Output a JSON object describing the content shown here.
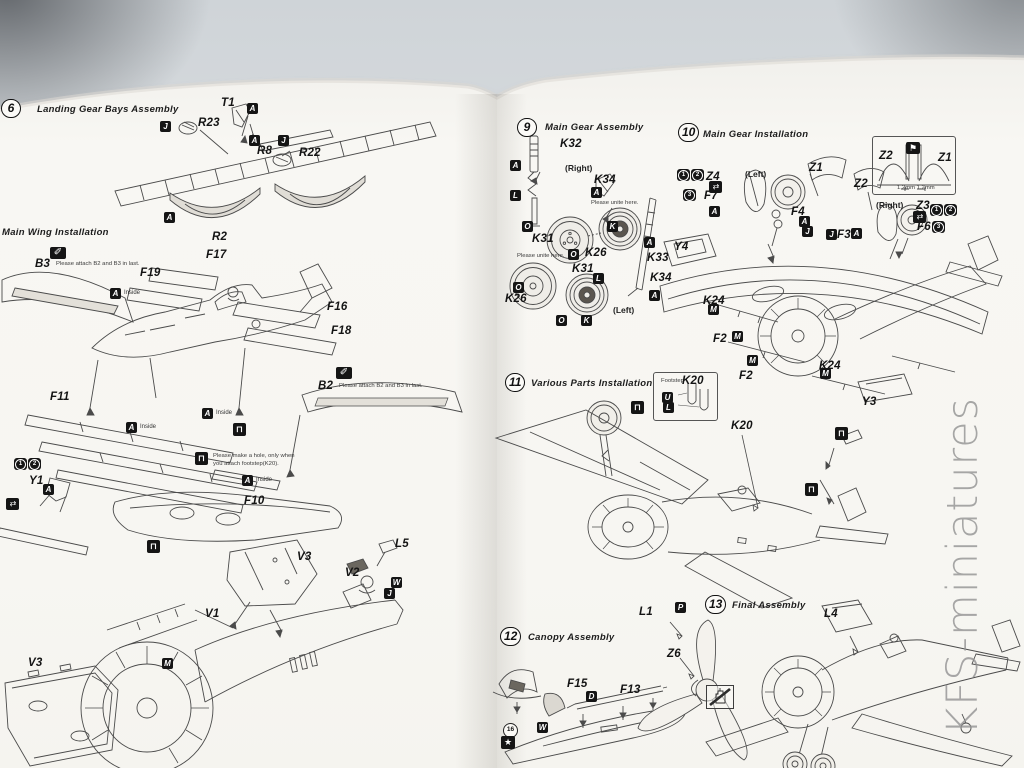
{
  "watermark": "KFS-miniatures",
  "colors": {
    "page": "#f8f7f3",
    "line": "#4b4b4b",
    "label": "#141414",
    "marker_bg": "#151515",
    "backdrop": "#d8dcdf"
  },
  "steps": [
    {
      "num": "6",
      "title": "Landing Gear Bays Assembly",
      "nx": 1,
      "ny": 99,
      "tx": 37,
      "ty": 104
    },
    {
      "num": null,
      "title": "Main Wing Installation",
      "nx": null,
      "ny": null,
      "tx": 2,
      "ty": 227
    },
    {
      "num": "9",
      "title": "Main Gear Assembly",
      "nx": 517,
      "ny": 118,
      "tx": 545,
      "ty": 122
    },
    {
      "num": "10",
      "title": "Main Gear Installation",
      "nx": 678,
      "ny": 123,
      "tx": 703,
      "ty": 129
    },
    {
      "num": "11",
      "title": "Various Parts Installation",
      "nx": 505,
      "ny": 373,
      "tx": 531,
      "ty": 378
    },
    {
      "num": "12",
      "title": "Canopy Assembly",
      "nx": 500,
      "ny": 627,
      "tx": 528,
      "ty": 632
    },
    {
      "num": "13",
      "title": "Final Assembly",
      "nx": 705,
      "ny": 595,
      "tx": 732,
      "ty": 600
    }
  ],
  "labels": [
    {
      "k": "part",
      "t": "T1",
      "x": 221,
      "y": 97
    },
    {
      "k": "paint",
      "t": "A",
      "x": 247,
      "y": 103
    },
    {
      "k": "paint",
      "t": "J",
      "x": 160,
      "y": 121
    },
    {
      "k": "part",
      "t": "R23",
      "x": 198,
      "y": 117
    },
    {
      "k": "paint",
      "t": "A",
      "x": 249,
      "y": 135
    },
    {
      "k": "paint",
      "t": "J",
      "x": 278,
      "y": 135
    },
    {
      "k": "part",
      "t": "R8",
      "x": 257,
      "y": 145
    },
    {
      "k": "part",
      "t": "R22",
      "x": 299,
      "y": 147
    },
    {
      "k": "paint",
      "t": "A",
      "x": 164,
      "y": 212
    },
    {
      "k": "part",
      "t": "R2",
      "x": 212,
      "y": 231
    },
    {
      "k": "glue",
      "x": 50,
      "y": 247
    },
    {
      "k": "part",
      "t": "B3",
      "x": 35,
      "y": 258
    },
    {
      "k": "note",
      "t": "Please attach B2 and B3 in last.",
      "x": 56,
      "y": 261,
      "nw": 1
    },
    {
      "k": "part",
      "t": "F17",
      "x": 206,
      "y": 249
    },
    {
      "k": "part",
      "t": "F19",
      "x": 140,
      "y": 267
    },
    {
      "k": "paint",
      "t": "A",
      "x": 110,
      "y": 288
    },
    {
      "k": "small",
      "t": "Inside",
      "x": 124,
      "y": 290
    },
    {
      "k": "part",
      "t": "F16",
      "x": 327,
      "y": 301
    },
    {
      "k": "part",
      "t": "F18",
      "x": 331,
      "y": 325
    },
    {
      "k": "glue",
      "x": 336,
      "y": 367
    },
    {
      "k": "part",
      "t": "B2",
      "x": 318,
      "y": 380
    },
    {
      "k": "note",
      "t": "Please attach B2 and B3 in last.",
      "x": 339,
      "y": 383,
      "nw": 1
    },
    {
      "k": "part",
      "t": "F11",
      "x": 50,
      "y": 391
    },
    {
      "k": "paint",
      "t": "A",
      "x": 202,
      "y": 408
    },
    {
      "k": "small",
      "t": "Inside",
      "x": 216,
      "y": 410
    },
    {
      "k": "paint",
      "t": "A",
      "x": 126,
      "y": 422
    },
    {
      "k": "small",
      "t": "Inside",
      "x": 140,
      "y": 424
    },
    {
      "k": "foot",
      "x": 233,
      "y": 423
    },
    {
      "k": "foot",
      "x": 195,
      "y": 452
    },
    {
      "k": "note",
      "t": "Please make a hole, only when you attach footstep(K20).",
      "x": 213,
      "y": 453,
      "w": 88
    },
    {
      "k": "paint",
      "t": "A",
      "x": 242,
      "y": 475
    },
    {
      "k": "small",
      "t": "Inside",
      "x": 256,
      "y": 477
    },
    {
      "k": "part",
      "t": "F10",
      "x": 244,
      "y": 495
    },
    {
      "k": "seq",
      "t": "1",
      "x": 14,
      "y": 458
    },
    {
      "k": "seq",
      "t": "2",
      "x": 28,
      "y": 458
    },
    {
      "k": "part",
      "t": "Y1",
      "x": 29,
      "y": 475
    },
    {
      "k": "paint",
      "t": "A",
      "x": 43,
      "y": 484
    },
    {
      "k": "arrows",
      "x": 6,
      "y": 498
    },
    {
      "k": "foot",
      "x": 147,
      "y": 540
    },
    {
      "k": "part",
      "t": "V3",
      "x": 297,
      "y": 551
    },
    {
      "k": "part",
      "t": "L5",
      "x": 395,
      "y": 538
    },
    {
      "k": "part",
      "t": "V2",
      "x": 345,
      "y": 567
    },
    {
      "k": "paint",
      "t": "W",
      "x": 391,
      "y": 577
    },
    {
      "k": "paint",
      "t": "J",
      "x": 384,
      "y": 588
    },
    {
      "k": "part",
      "t": "V1",
      "x": 205,
      "y": 608
    },
    {
      "k": "paint",
      "t": "M",
      "x": 162,
      "y": 658
    },
    {
      "k": "part",
      "t": "V3",
      "x": 28,
      "y": 657
    },
    {
      "k": "part",
      "t": "K32",
      "x": 560,
      "y": 138
    },
    {
      "k": "paint",
      "t": "A",
      "x": 510,
      "y": 160
    },
    {
      "k": "dir",
      "t": "(Right)",
      "x": 565,
      "y": 163
    },
    {
      "k": "part",
      "t": "K34",
      "x": 594,
      "y": 174
    },
    {
      "k": "paint",
      "t": "A",
      "x": 591,
      "y": 187
    },
    {
      "k": "paint",
      "t": "L",
      "x": 510,
      "y": 190
    },
    {
      "k": "note",
      "t": "Please unite here.",
      "x": 591,
      "y": 200,
      "nw": 1
    },
    {
      "k": "paint",
      "t": "O",
      "x": 522,
      "y": 221
    },
    {
      "k": "paint",
      "t": "K",
      "x": 607,
      "y": 221
    },
    {
      "k": "part",
      "t": "K31",
      "x": 532,
      "y": 233
    },
    {
      "k": "part",
      "t": "K26",
      "x": 585,
      "y": 247
    },
    {
      "k": "paint",
      "t": "O",
      "x": 568,
      "y": 249
    },
    {
      "k": "paint",
      "t": "A",
      "x": 644,
      "y": 237
    },
    {
      "k": "part",
      "t": "K33",
      "x": 647,
      "y": 252
    },
    {
      "k": "note",
      "t": "Please unite here.",
      "x": 517,
      "y": 253,
      "nw": 1
    },
    {
      "k": "part",
      "t": "K31",
      "x": 572,
      "y": 263
    },
    {
      "k": "paint",
      "t": "L",
      "x": 593,
      "y": 273
    },
    {
      "k": "part",
      "t": "K34",
      "x": 650,
      "y": 272
    },
    {
      "k": "paint",
      "t": "O",
      "x": 513,
      "y": 282
    },
    {
      "k": "part",
      "t": "K26",
      "x": 505,
      "y": 293
    },
    {
      "k": "paint",
      "t": "A",
      "x": 649,
      "y": 290
    },
    {
      "k": "dir",
      "t": "(Left)",
      "x": 613,
      "y": 305
    },
    {
      "k": "paint",
      "t": "O",
      "x": 556,
      "y": 315
    },
    {
      "k": "paint",
      "t": "K",
      "x": 581,
      "y": 315
    },
    {
      "k": "seq",
      "t": "1",
      "x": 677,
      "y": 169
    },
    {
      "k": "seq",
      "t": "2",
      "x": 691,
      "y": 169
    },
    {
      "k": "part",
      "t": "Z4",
      "x": 706,
      "y": 171
    },
    {
      "k": "arrows",
      "x": 709,
      "y": 181
    },
    {
      "k": "seq",
      "t": "3",
      "x": 683,
      "y": 189
    },
    {
      "k": "part",
      "t": "F7",
      "x": 704,
      "y": 190
    },
    {
      "k": "dir",
      "t": "(Left)",
      "x": 745,
      "y": 169
    },
    {
      "k": "part",
      "t": "Z1",
      "x": 809,
      "y": 162
    },
    {
      "k": "paint",
      "t": "A",
      "x": 709,
      "y": 206
    },
    {
      "k": "part",
      "t": "F4",
      "x": 791,
      "y": 206
    },
    {
      "k": "paint",
      "t": "A",
      "x": 799,
      "y": 216
    },
    {
      "k": "paint",
      "t": "J",
      "x": 802,
      "y": 226
    },
    {
      "k": "paint",
      "t": "J",
      "x": 826,
      "y": 229
    },
    {
      "k": "part",
      "t": "F3",
      "x": 837,
      "y": 229
    },
    {
      "k": "paint",
      "t": "A",
      "x": 851,
      "y": 228
    },
    {
      "k": "part",
      "t": "Z2",
      "x": 879,
      "y": 150
    },
    {
      "k": "flag",
      "x": 906,
      "y": 142
    },
    {
      "k": "part",
      "t": "Z1",
      "x": 938,
      "y": 152
    },
    {
      "k": "note",
      "t": "1.2mm  1.2mm",
      "x": 897,
      "y": 185,
      "nw": 1
    },
    {
      "k": "part",
      "t": "Z2",
      "x": 854,
      "y": 178
    },
    {
      "k": "dir",
      "t": "(Right)",
      "x": 876,
      "y": 200
    },
    {
      "k": "part",
      "t": "Z3",
      "x": 916,
      "y": 200
    },
    {
      "k": "seq",
      "t": "1",
      "x": 930,
      "y": 204
    },
    {
      "k": "seq",
      "t": "2",
      "x": 944,
      "y": 204
    },
    {
      "k": "arrows",
      "x": 913,
      "y": 211
    },
    {
      "k": "part",
      "t": "F6",
      "x": 917,
      "y": 221
    },
    {
      "k": "seq",
      "t": "3",
      "x": 932,
      "y": 221
    },
    {
      "k": "part",
      "t": "Y4",
      "x": 674,
      "y": 241
    },
    {
      "k": "part",
      "t": "K24",
      "x": 703,
      "y": 295
    },
    {
      "k": "paint",
      "t": "M",
      "x": 708,
      "y": 304
    },
    {
      "k": "part",
      "t": "F2",
      "x": 713,
      "y": 333
    },
    {
      "k": "paint",
      "t": "M",
      "x": 732,
      "y": 331
    },
    {
      "k": "paint",
      "t": "M",
      "x": 747,
      "y": 355
    },
    {
      "k": "part",
      "t": "F2",
      "x": 739,
      "y": 370
    },
    {
      "k": "part",
      "t": "K24",
      "x": 819,
      "y": 360
    },
    {
      "k": "paint",
      "t": "M",
      "x": 820,
      "y": 368
    },
    {
      "k": "part",
      "t": "Y3",
      "x": 862,
      "y": 396
    },
    {
      "k": "note",
      "t": "Footstep",
      "x": 661,
      "y": 378,
      "nw": 1
    },
    {
      "k": "part",
      "t": "K20",
      "x": 682,
      "y": 375
    },
    {
      "k": "paint",
      "t": "U",
      "x": 662,
      "y": 392
    },
    {
      "k": "paint",
      "t": "L",
      "x": 663,
      "y": 402
    },
    {
      "k": "foot",
      "x": 631,
      "y": 401
    },
    {
      "k": "part",
      "t": "K20",
      "x": 731,
      "y": 420
    },
    {
      "k": "foot",
      "x": 835,
      "y": 427
    },
    {
      "k": "foot",
      "x": 805,
      "y": 483
    },
    {
      "k": "part",
      "t": "F15",
      "x": 567,
      "y": 678
    },
    {
      "k": "paint",
      "t": "D",
      "x": 586,
      "y": 691
    },
    {
      "k": "part",
      "t": "F13",
      "x": 620,
      "y": 684
    },
    {
      "k": "paint",
      "t": "W",
      "x": 537,
      "y": 722
    },
    {
      "k": "circ",
      "t": "16",
      "x": 503,
      "y": 723
    },
    {
      "k": "star",
      "x": 501,
      "y": 736
    },
    {
      "k": "part",
      "t": "L1",
      "x": 639,
      "y": 606
    },
    {
      "k": "paint",
      "t": "P",
      "x": 675,
      "y": 602
    },
    {
      "k": "part",
      "t": "Z6",
      "x": 667,
      "y": 648
    },
    {
      "k": "part",
      "t": "L4",
      "x": 824,
      "y": 608
    }
  ]
}
